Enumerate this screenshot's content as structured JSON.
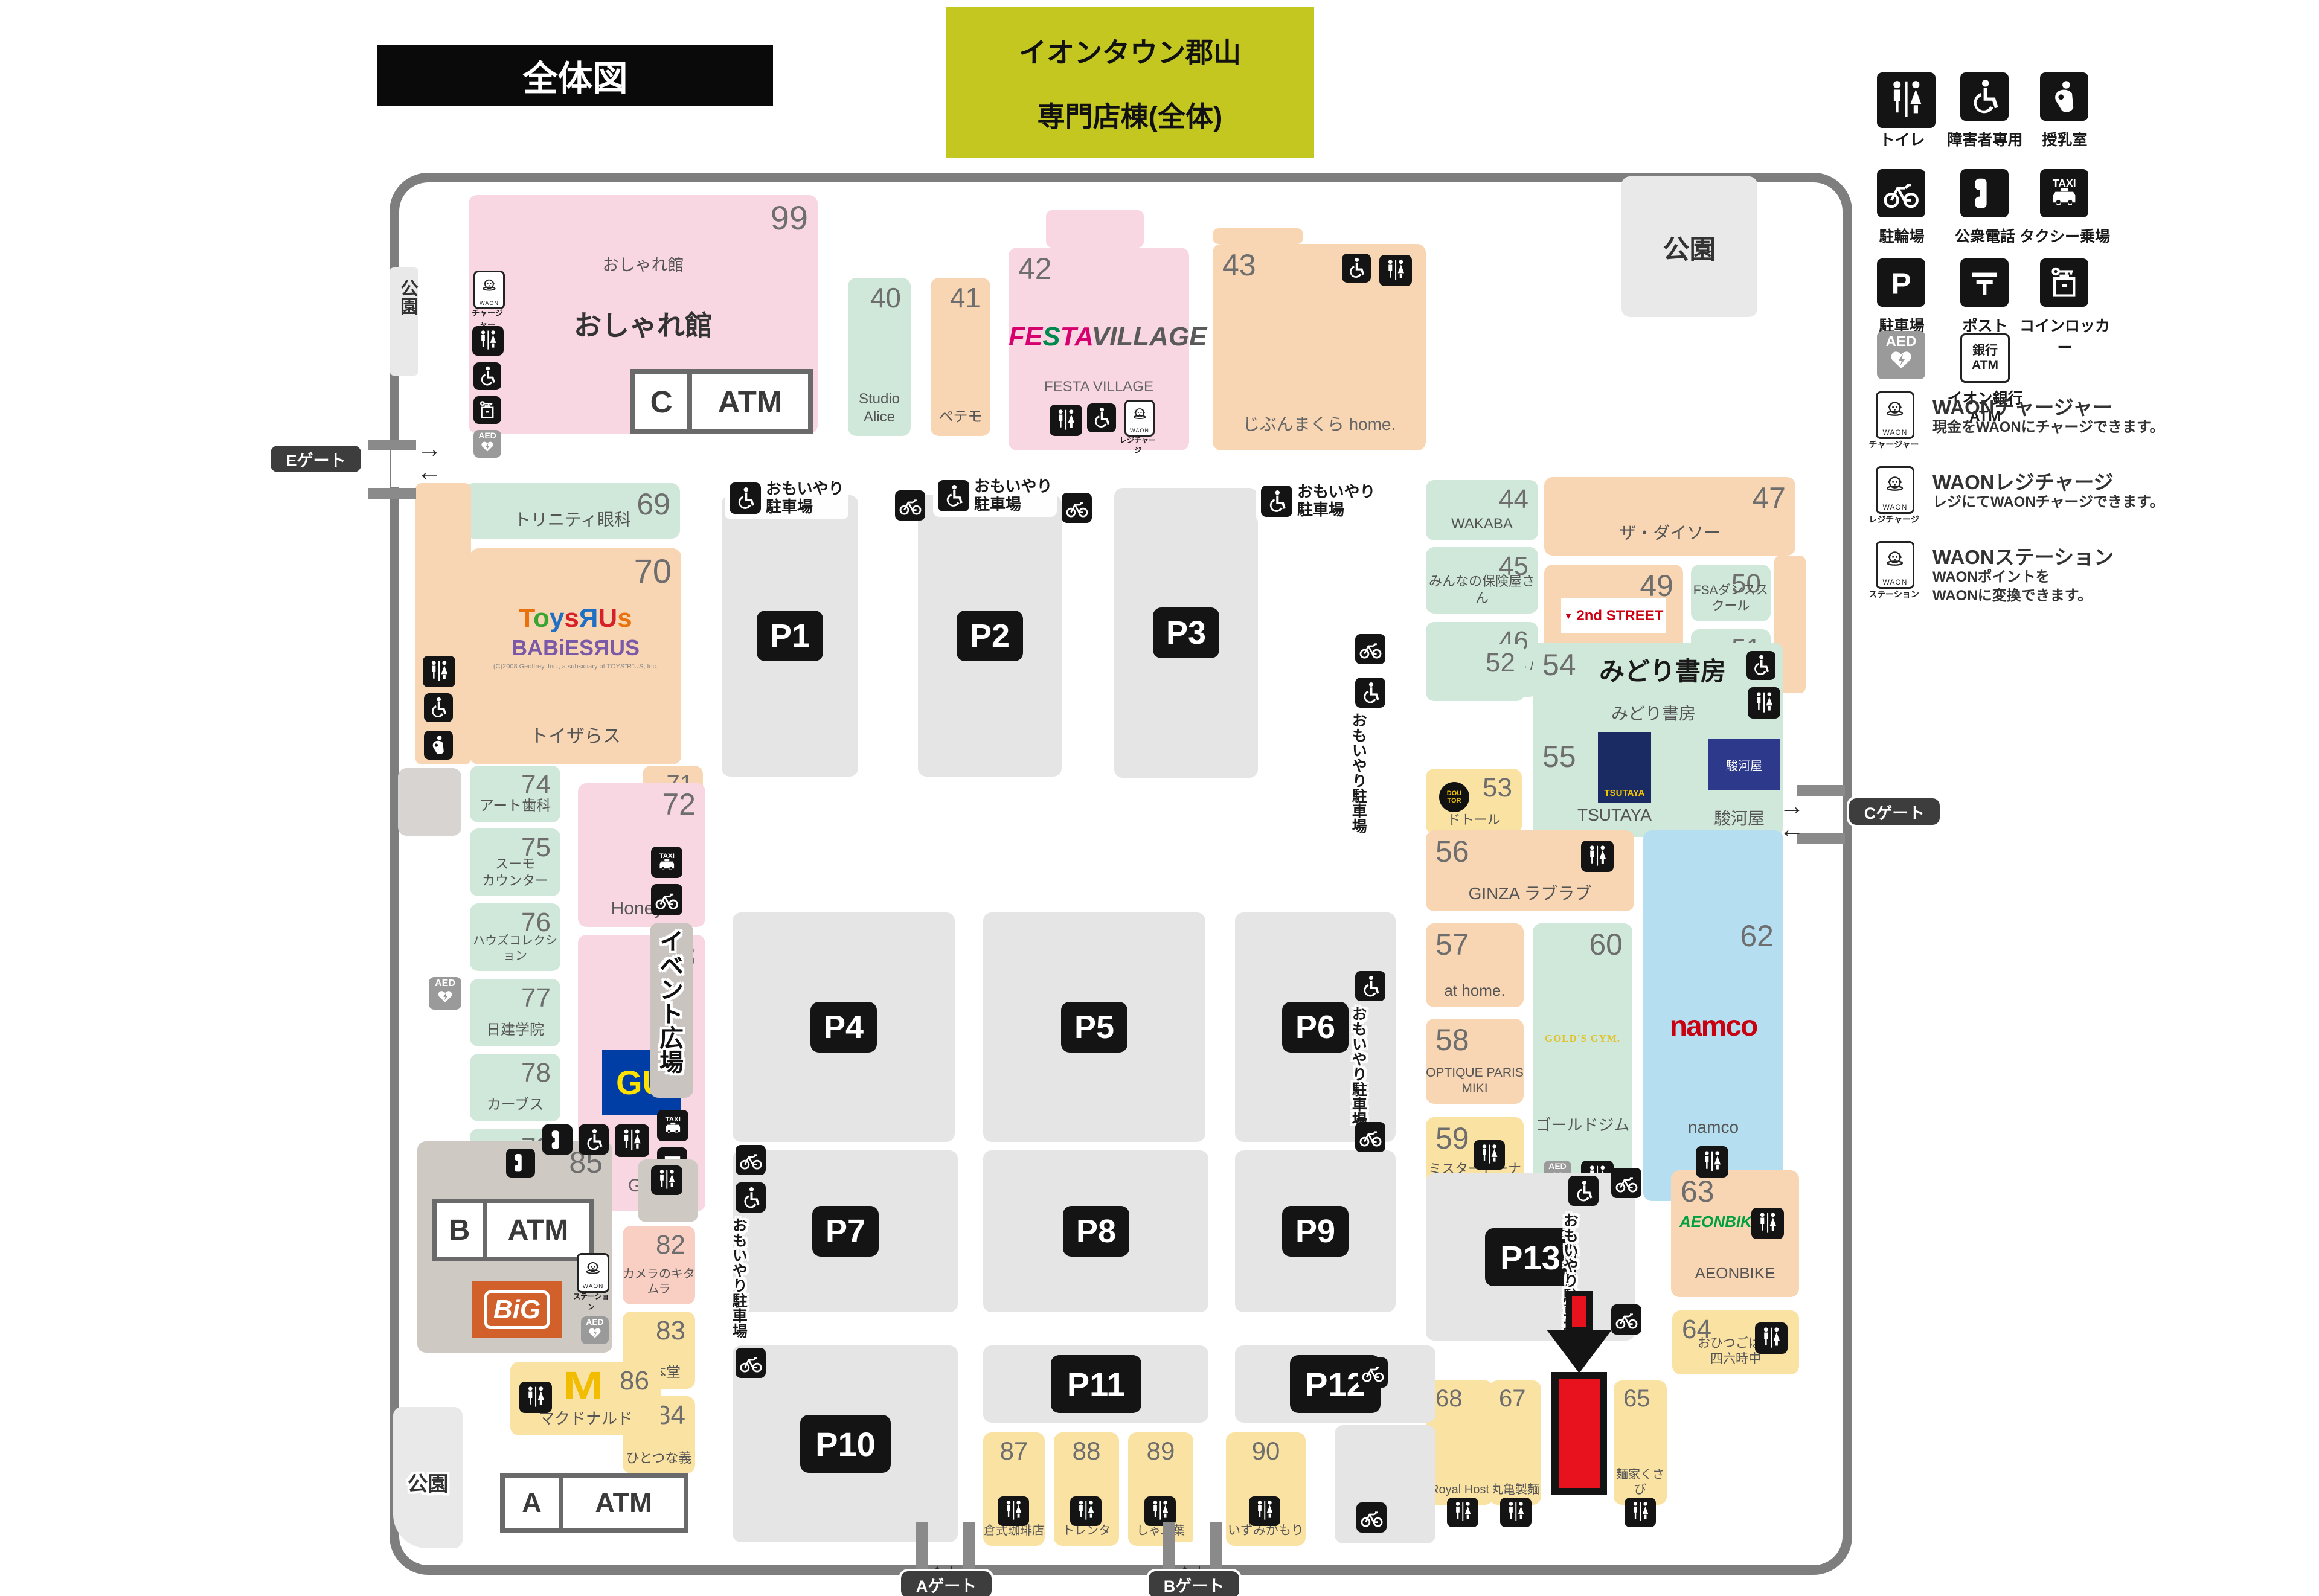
{
  "title": {
    "map_label": "全体図",
    "building_line1": "イオンタウン郡山",
    "building_line2": "専門店棟(全体)"
  },
  "legend": {
    "facilities": [
      {
        "icon": "toilet",
        "label": "トイレ"
      },
      {
        "icon": "wheelchair",
        "label": "障害者専用"
      },
      {
        "icon": "nursing",
        "label": "授乳室"
      },
      {
        "icon": "bicycle",
        "label": "駐輪場"
      },
      {
        "icon": "phone",
        "label": "公衆電話"
      },
      {
        "icon": "taxi",
        "label": "タクシー乗場"
      },
      {
        "icon": "parking",
        "label": "駐車場"
      },
      {
        "icon": "post",
        "label": "ポスト"
      },
      {
        "icon": "locker",
        "label": "コインロッカー"
      },
      {
        "icon": "aed",
        "label": ""
      },
      {
        "icon": "bankatm",
        "label": "イオン銀行ATM"
      }
    ],
    "waon": [
      {
        "tag": "チャージャー",
        "title": "WAONチャージャー",
        "desc": [
          "現金をWAONにチャージできます。"
        ]
      },
      {
        "tag": "レジチャージ",
        "title": "WAONレジチャージ",
        "desc": [
          "レジにてWAONチャージできます。"
        ]
      },
      {
        "tag": "ステーション",
        "title": "WAONステーション",
        "desc": [
          "WAONポイントを",
          "WAONに変換できます。"
        ]
      }
    ]
  },
  "gates": {
    "a": "Aゲート",
    "b": "Bゲート",
    "c": "Cゲート",
    "e": "Eゲート"
  },
  "park_label": "公園",
  "omoiyari": [
    "おもいやり",
    "駐車場"
  ],
  "event_space": "イベント広場",
  "atm_label": "ATM",
  "atm_ids": {
    "a": "A",
    "b": "B",
    "c": "C"
  },
  "waon_box_text": "WAON",
  "parking_labels": [
    "P1",
    "P2",
    "P3",
    "P4",
    "P5",
    "P6",
    "P7",
    "P8",
    "P9",
    "P10",
    "P11",
    "P12",
    "P13"
  ],
  "toys_copyright": "(C)2008 Geoffrey, Inc., a subsidiary of TOYS\"R\"US, Inc.",
  "logo_text": {
    "festa_1": "FESTA",
    "festa_2": "VILLAGE",
    "gu": "GU",
    "big": "BiG",
    "mcd": "M",
    "second_main": "2nd STREET",
    "second_sub": "Reuse Shop",
    "toys_1": "ToysЯUs",
    "toys_2": "BABiESЯUS",
    "golds": "GOLD'S GYM.",
    "namco": "namco",
    "aeonbike": "AEONBIKE",
    "tsutaya": "TSUTAYA",
    "suruga": "駿河屋",
    "doutor": "DOUTOR",
    "bank": "銀行"
  },
  "stores": [
    {
      "id": "s99",
      "num": "99",
      "name": "おしゃれ館",
      "sub": "おしゃれ館",
      "color": "pink"
    },
    {
      "id": "s40",
      "num": "40",
      "name": "Studio Alice",
      "color": "green"
    },
    {
      "id": "s41",
      "num": "41",
      "name": "ペテモ",
      "color": "peach"
    },
    {
      "id": "s42",
      "num": "42",
      "name": "FESTA VILLAGE",
      "color": "pink",
      "logo": "festa"
    },
    {
      "id": "s43",
      "num": "43",
      "name": "じぶんまくら home.",
      "color": "peach"
    },
    {
      "id": "s44",
      "num": "44",
      "name": "WAKABA",
      "color": "green"
    },
    {
      "id": "s45",
      "num": "45",
      "name": "みんなの保険屋さん",
      "color": "green"
    },
    {
      "id": "s46",
      "num": "46",
      "name": [
        "エックスモバイル /",
        "まちの人事部"
      ],
      "color": "green"
    },
    {
      "id": "s47",
      "num": "47",
      "name": "ザ・ダイソー",
      "color": "peach"
    },
    {
      "id": "s49",
      "num": "49",
      "name": "セカンドストリート",
      "color": "peach",
      "logo": "second"
    },
    {
      "id": "s50",
      "num": "50",
      "name": "FSAダンススクール",
      "color": "green"
    },
    {
      "id": "s51",
      "num": "51",
      "name": [
        "ペッピー",
        "キッズクラブ"
      ],
      "color": "green"
    },
    {
      "id": "s52",
      "num": "52",
      "name": "",
      "color": "green"
    },
    {
      "id": "s53",
      "num": "53",
      "name": "ドトール",
      "color": "yellow",
      "logo": "doutor"
    },
    {
      "id": "s5455",
      "num": "54",
      "num2": "55",
      "name": "みどり書房",
      "sub": "みどり書房",
      "color": "green"
    },
    {
      "id": "s56",
      "num": "56",
      "name": "GINZA ラブラブ",
      "color": "peach"
    },
    {
      "id": "s57",
      "num": "57",
      "name": "at home.",
      "color": "peach"
    },
    {
      "id": "s58",
      "num": "58",
      "name": "OPTIQUE PARIS MIKI",
      "color": "peach"
    },
    {
      "id": "s59",
      "num": "59",
      "name": "ミスタードーナツ",
      "color": "yellow"
    },
    {
      "id": "s60",
      "num": "60",
      "name": "ゴールドジム",
      "color": "green",
      "logo": "golds"
    },
    {
      "id": "s61",
      "num": "61",
      "name": "LAVA",
      "color": "green"
    },
    {
      "id": "s62",
      "num": "62",
      "name": "namco",
      "color": "blue",
      "logo": "namco"
    },
    {
      "id": "s63",
      "num": "63",
      "name": "AEONBIKE",
      "color": "peach",
      "logo": "aeonbike"
    },
    {
      "id": "s64",
      "num": "64",
      "name": [
        "おひつごはん",
        "四六時中"
      ],
      "color": "yellow"
    },
    {
      "id": "s65",
      "num": "65",
      "name": "麺家くさび",
      "color": "yellow"
    },
    {
      "id": "s67",
      "num": "67",
      "name": "丸亀製麺",
      "color": "yellow"
    },
    {
      "id": "s68",
      "num": "68",
      "name": "Royal Host",
      "color": "yellow"
    },
    {
      "id": "s69",
      "num": "69",
      "name": "トリニティ眼科",
      "color": "green"
    },
    {
      "id": "s70",
      "num": "70",
      "name": "トイザらス",
      "color": "peach",
      "logo": "toys"
    },
    {
      "id": "s71",
      "num": "71",
      "name": [
        "チャンス",
        "センター"
      ],
      "color": "peach"
    },
    {
      "id": "s72",
      "num": "72",
      "name": "Honeys",
      "color": "pink"
    },
    {
      "id": "s73",
      "num": "73",
      "name": "GU",
      "color": "pink",
      "logo": "gu"
    },
    {
      "id": "s74",
      "num": "74",
      "name": "アート歯科",
      "color": "green"
    },
    {
      "id": "s75",
      "num": "75",
      "name": [
        "スーモ",
        "カウンター"
      ],
      "color": "green"
    },
    {
      "id": "s76",
      "num": "76",
      "name": "ハウズコレクション",
      "color": "green"
    },
    {
      "id": "s77",
      "num": "77",
      "name": "日建学院",
      "color": "green"
    },
    {
      "id": "s78",
      "num": "78",
      "name": "カーブス",
      "color": "green"
    },
    {
      "id": "s79",
      "num": "79",
      "name": "みとみ学園",
      "color": "green"
    },
    {
      "id": "s80",
      "num": "80",
      "name": [
        "ジェイ",
        "エステティック"
      ],
      "color": "green"
    },
    {
      "id": "s82",
      "num": "82",
      "name": "カメラのキタムラ",
      "color": "salmon"
    },
    {
      "id": "s83",
      "num": "83",
      "name": "一本堂",
      "color": "yellow"
    },
    {
      "id": "s84",
      "num": "84",
      "name": "ひとつな義",
      "color": "yellow"
    },
    {
      "id": "s85",
      "num": "85",
      "name": "",
      "color": "taupe",
      "logo": "big"
    },
    {
      "id": "s86",
      "num": "86",
      "name": "マクドナルド",
      "color": "yellow",
      "logo": "mcd"
    },
    {
      "id": "s87",
      "num": "87",
      "name": "倉式珈琲店",
      "color": "yellow"
    },
    {
      "id": "s88",
      "num": "88",
      "name": "トレンタ",
      "color": "yellow"
    },
    {
      "id": "s89",
      "num": "89",
      "name": "しゃぶ葉",
      "color": "yellow"
    },
    {
      "id": "s90",
      "num": "90",
      "name": "いずみがもり",
      "color": "yellow"
    }
  ],
  "colors": {
    "pink": "#f9d7e2",
    "peach": "#f9d6b3",
    "green": "#cfe8d9",
    "yellow": "#fae2a2",
    "blue": "#b5dff0",
    "salmon": "#f8cfc2",
    "taupe": "#cfc9c3",
    "lot_gray": "#e5e5e5",
    "light_gray": "#e9e9e9",
    "border_gray": "#7e7e7e",
    "title_yellow": "#c3c71f",
    "highlight_red": "#e8121e",
    "gu_bg": "#003da5",
    "gu_text": "#ffe100",
    "big_bg": "#d2602a",
    "mcd_yellow": "#f2bc00",
    "namco_red": "#c8000f",
    "aeonbike_green": "#00a040",
    "golds_yellow": "#e2c229",
    "festa_pink": "#d6006f",
    "festa_green": "#00894e",
    "festa_gray": "#5a5a5a",
    "second_red": "#cc0011",
    "tsutaya_navy": "#1a2a63",
    "suruga_navy": "#2d3a8c",
    "babies_purple": "#7a5aa8",
    "toys_colors": [
      "#e8730c",
      "#3aa535",
      "#1f6fc4",
      "#d6212a",
      "#1f6fc4",
      "#d6212a",
      "#e8730c"
    ]
  }
}
